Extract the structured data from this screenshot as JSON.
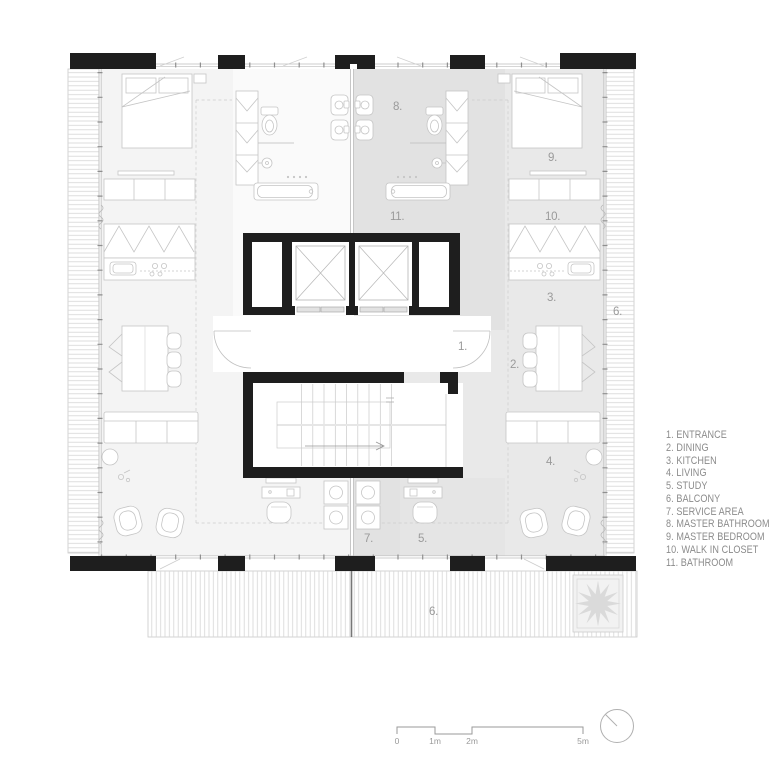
{
  "document": {
    "type": "architectural-floor-plan",
    "description": "Residential floor plan with two mirrored units around a central elevator and stair core"
  },
  "colors": {
    "wall_black": "#1e1e1e",
    "unit_left_bg": "#f4f4f4",
    "unit_right_bg": "#e9e9e9",
    "service_zone_bg": "#e2e2e2",
    "furniture_stroke": "#c5c5c5",
    "hatch_line": "#d6d6d6",
    "room_label_text": "#9a9a9a",
    "legend_text": "#8b8b8b"
  },
  "legend": {
    "items": [
      "1. ENTRANCE",
      "2. DINING",
      "3. KITCHEN",
      "4. LIVING",
      "5. STUDY",
      "6. BALCONY",
      "7. SERVICE AREA",
      "8. MASTER BATHROOM",
      "9. MASTER BEDROOM",
      "10. WALK IN CLOSET",
      "11. BATHROOM"
    ]
  },
  "plan": {
    "room_labels": [
      {
        "room": "entrance",
        "text": "1."
      },
      {
        "room": "dining",
        "text": "2."
      },
      {
        "room": "kitchen",
        "text": "3."
      },
      {
        "room": "living",
        "text": "4."
      },
      {
        "room": "study",
        "text": "5."
      },
      {
        "room": "balcony-right",
        "text": "6."
      },
      {
        "room": "balcony-bottom",
        "text": "6."
      },
      {
        "room": "service-area",
        "text": "7."
      },
      {
        "room": "master-bathroom",
        "text": "8."
      },
      {
        "room": "master-bedroom",
        "text": "9."
      },
      {
        "room": "walk-in-closet",
        "text": "10."
      },
      {
        "room": "bathroom",
        "text": "11."
      }
    ]
  },
  "scale_bar": {
    "labels": [
      "0",
      "1m",
      "2m",
      "5m"
    ]
  },
  "north_indicator": {
    "type": "circle-with-needle",
    "needle_direction": "north-west"
  }
}
